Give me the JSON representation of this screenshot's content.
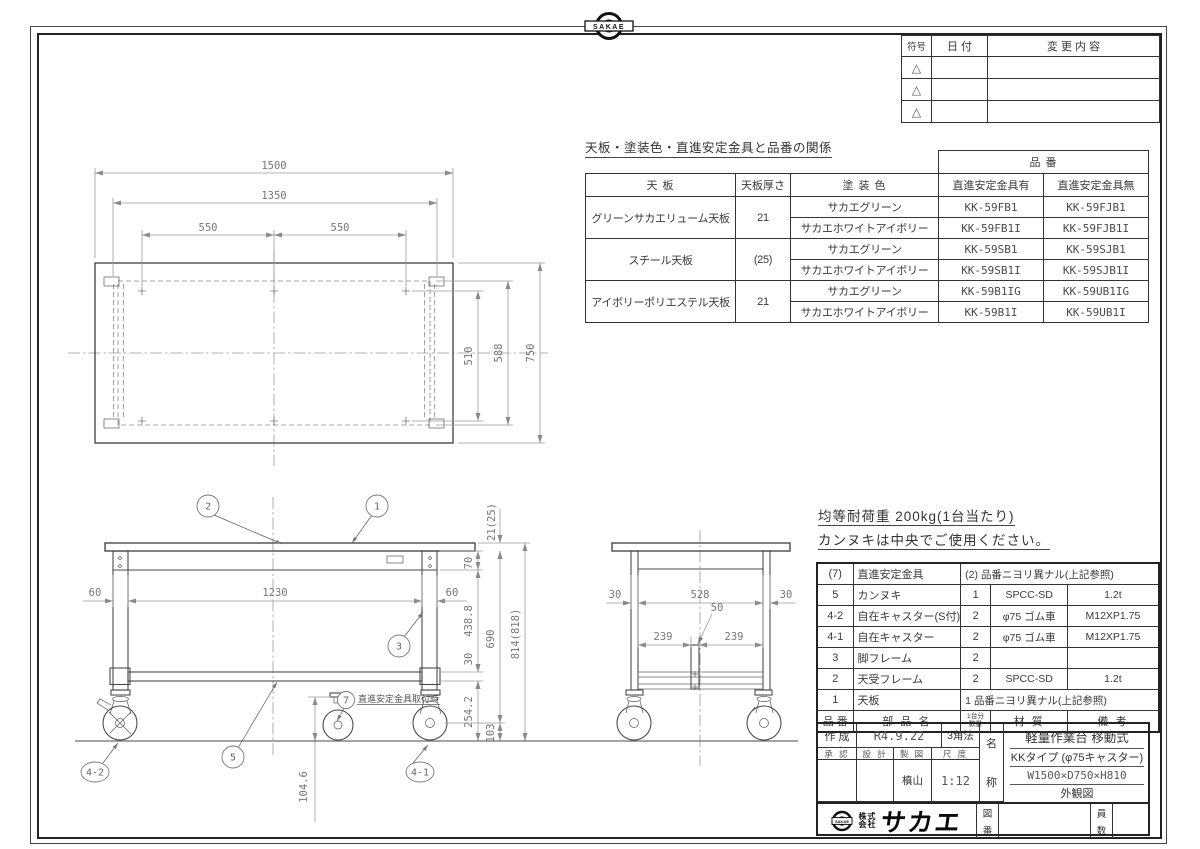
{
  "badge": {
    "text": "SAKAE"
  },
  "revision_table": {
    "col_symbol": "符号",
    "col_date": "日  付",
    "col_change": "変 更 内 容",
    "symbol": "△"
  },
  "relation_table": {
    "title": "天板・塗装色・直進安定金具と品番の関係",
    "col_tenban": "天 板",
    "col_thickness": "天板厚さ",
    "col_color": "塗 装 色",
    "col_hinban": "品  番",
    "col_with": "直進安定金具有",
    "col_without": "直進安定金具無",
    "groups": [
      {
        "tenban": "グリーンサカエリューム天板",
        "thickness": "21",
        "rows": [
          {
            "color": "サカエグリーン",
            "w": "KK-59FB1",
            "wo": "KK-59FJB1"
          },
          {
            "color": "サカエホワイトアイボリー",
            "w": "KK-59FB1I",
            "wo": "KK-59FJB1I"
          }
        ]
      },
      {
        "tenban": "スチール天板",
        "thickness": "(25)",
        "rows": [
          {
            "color": "サカエグリーン",
            "w": "KK-59SB1",
            "wo": "KK-59SJB1"
          },
          {
            "color": "サカエホワイトアイボリー",
            "w": "KK-59SB1I",
            "wo": "KK-59SJB1I"
          }
        ]
      },
      {
        "tenban": "アイボリーポリエステル天板",
        "thickness": "21",
        "rows": [
          {
            "color": "サカエグリーン",
            "w": "KK-59B1IG",
            "wo": "KK-59UB1IG"
          },
          {
            "color": "サカエホワイトアイボリー",
            "w": "KK-59B1I",
            "wo": "KK-59UB1I"
          }
        ]
      }
    ]
  },
  "notes": {
    "load": "均等耐荷重  200kg(1台当たり)",
    "usage": "カンヌキは中央でご使用ください。"
  },
  "bom": {
    "header": {
      "no": "品 番",
      "name": "部 品 名",
      "qty_top": "1台分",
      "qty_bottom": "数量",
      "material": "材  質",
      "remark": "備  考"
    },
    "rows": [
      {
        "no": "(7)",
        "name": "直進安定金具",
        "qty": "(2)",
        "merged": "品番ニヨリ異ナル(上記参照)"
      },
      {
        "no": "5",
        "name": "カンヌキ",
        "qty": "1",
        "material": "SPCC-SD",
        "remark": "1.2t"
      },
      {
        "no": "4-2",
        "name": "自在キャスター(S付)",
        "qty": "2",
        "material": "φ75 ゴム車",
        "remark": "M12XP1.75"
      },
      {
        "no": "4-1",
        "name": "自在キャスター",
        "qty": "2",
        "material": "φ75 ゴム車",
        "remark": "M12XP1.75"
      },
      {
        "no": "3",
        "name": "脚フレーム",
        "qty": "2",
        "material": "",
        "remark": ""
      },
      {
        "no": "2",
        "name": "天受フレーム",
        "qty": "2",
        "material": "SPCC-SD",
        "remark": "1.2t"
      },
      {
        "no": "1",
        "name": "天板",
        "qty": "1",
        "merged": "品番ニヨリ異ナル(上記参照)"
      }
    ]
  },
  "title_block": {
    "created_label": "作 成",
    "created_date": "R4.9.22",
    "projection": "3角法",
    "approve": "承 認",
    "design": "設 計",
    "draft": "製 図",
    "scale_label": "尺 度",
    "drafter": "槙山",
    "scale": "1:12",
    "name_label_1": "名",
    "name_label_2": "称",
    "product_line1": "軽量作業台 移動式",
    "product_line2": "KKタイプ (φ75キャスター)",
    "product_line3": "W1500×D750×H810",
    "product_line4": "外観図",
    "company_prefix_1": "株式",
    "company_prefix_2": "会社",
    "company_name": "サカエ",
    "company_badge": "SAKAE",
    "drawing_no_1": "図",
    "drawing_no_2": "番",
    "qty_no_1": "員",
    "qty_no_2": "数"
  },
  "top_view": {
    "d1500": "1500",
    "d1350": "1350",
    "d550a": "550",
    "d550b": "550",
    "d510": "510",
    "d588": "588",
    "d750": "750"
  },
  "front_view": {
    "d60l": "60",
    "d1230": "1230",
    "d60r": "60",
    "d21": "21(25)",
    "d70": "70",
    "d438": "438.8",
    "d690": "690",
    "d814": "814(818)",
    "d30": "30",
    "d254": "254.2",
    "d103": "103",
    "d104": "104.6",
    "b1": "1",
    "b2": "2",
    "b3": "3",
    "b5": "5",
    "b7": "7",
    "b41": "4-1",
    "b42": "4-2",
    "note7": "直進安定金具取付時"
  },
  "side_view": {
    "d30l": "30",
    "d528": "528",
    "d30r": "30",
    "d239l": "239",
    "d239r": "239",
    "d50": "50"
  }
}
